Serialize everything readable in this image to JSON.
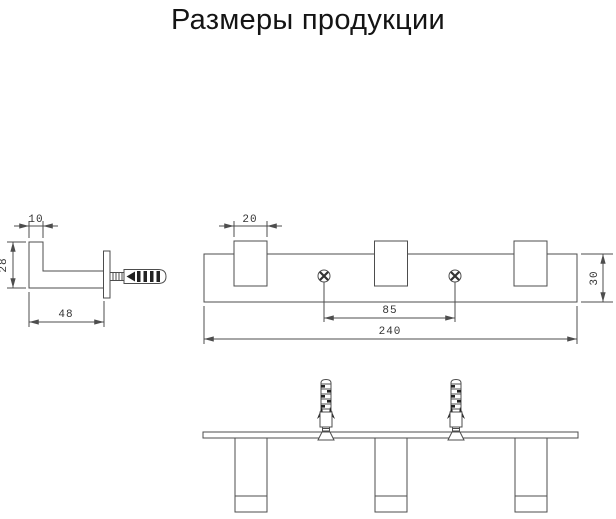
{
  "title": "Размеры продукции",
  "drawing": {
    "side_view": {
      "dims": {
        "hook_top_width": "10",
        "hook_height": "28",
        "hook_depth": "48"
      }
    },
    "front_view": {
      "dims": {
        "hook_width": "20",
        "screw_spacing": "85",
        "total_length": "240",
        "rail_height": "30"
      }
    }
  },
  "colors": {
    "background": "#ffffff",
    "line": "#4d4d4d",
    "dimension_text": "#333333",
    "title_text": "#141414",
    "dark_detail": "#222222"
  }
}
